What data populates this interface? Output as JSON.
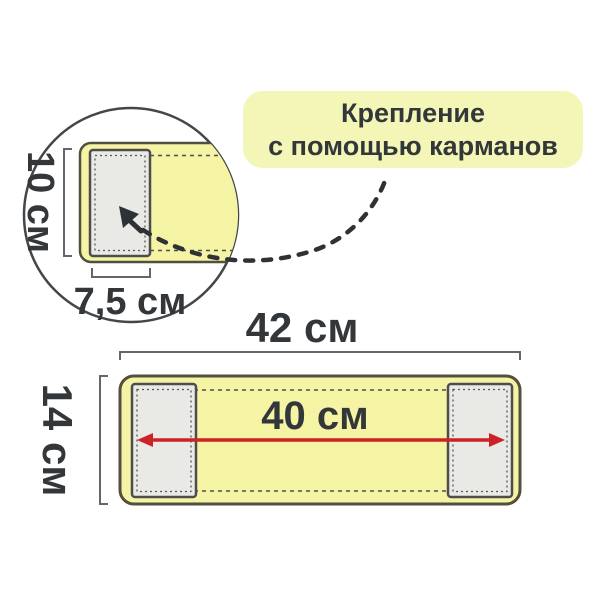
{
  "callout": {
    "line1": "Крепление",
    "line2": "с помощью карманов"
  },
  "detail_view": {
    "pocket_height_label": "10 см",
    "pocket_width_label": "7,5 см"
  },
  "main_view": {
    "total_width_label": "42 см",
    "total_height_label": "14 см",
    "inner_width_label": "40 см"
  },
  "colors": {
    "product_fill": "#f5f3a4",
    "product_border": "#51503f",
    "pocket_fill": "#e9e9e5",
    "pocket_border": "#4d4d4d",
    "callout_fill": "#f3f6b6",
    "accent_red": "#cc2127",
    "text": "#33373a",
    "bracket": "#63676b",
    "circle_outline": "#43474a"
  }
}
